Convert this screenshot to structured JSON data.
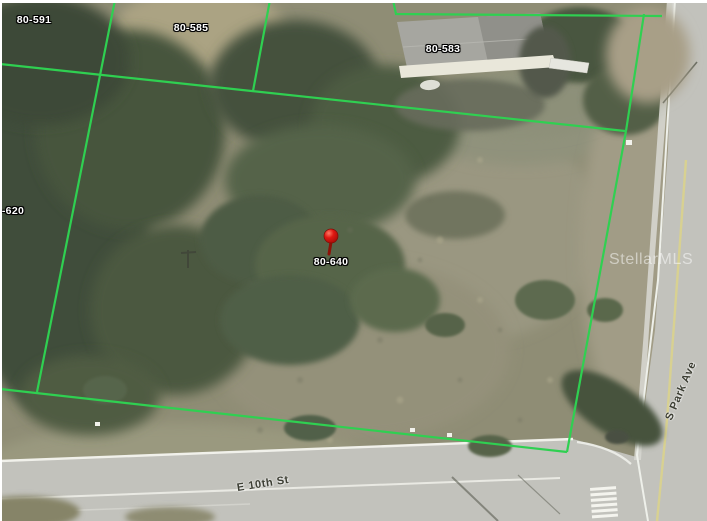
{
  "map": {
    "watermark": "StellarMLS",
    "boundary_color": "#2fd051",
    "boundary_lines": [
      [
        [
          0,
          64
        ],
        [
          625,
          131
        ]
      ],
      [
        [
          115,
          0
        ],
        [
          37,
          392
        ]
      ],
      [
        [
          270,
          0
        ],
        [
          253,
          91
        ]
      ],
      [
        [
          393,
          0
        ],
        [
          396,
          14
        ],
        [
          662,
          16
        ]
      ],
      [
        [
          644,
          14
        ],
        [
          626,
          131
        ]
      ],
      [
        [
          626,
          131
        ],
        [
          567,
          452
        ]
      ],
      [
        [
          0,
          389
        ],
        [
          567,
          452
        ]
      ]
    ],
    "marker": {
      "x": 331,
      "y": 236,
      "head_color": "#e01812",
      "stem_color": "#8c1208"
    },
    "parcel_labels": [
      {
        "id": "80-591",
        "x": 34,
        "y": 20
      },
      {
        "id": "80-585",
        "x": 191,
        "y": 28
      },
      {
        "id": "80-583",
        "x": 443,
        "y": 49
      },
      {
        "id": "-620",
        "x": 13,
        "y": 211
      },
      {
        "id": "80-640",
        "x": 331,
        "y": 262
      }
    ],
    "street_labels": [
      {
        "name": "E 10th St",
        "x": 263,
        "y": 484,
        "rotate": -9
      },
      {
        "name": "S Park Ave",
        "x": 681,
        "y": 391,
        "rotate": -67
      }
    ]
  }
}
